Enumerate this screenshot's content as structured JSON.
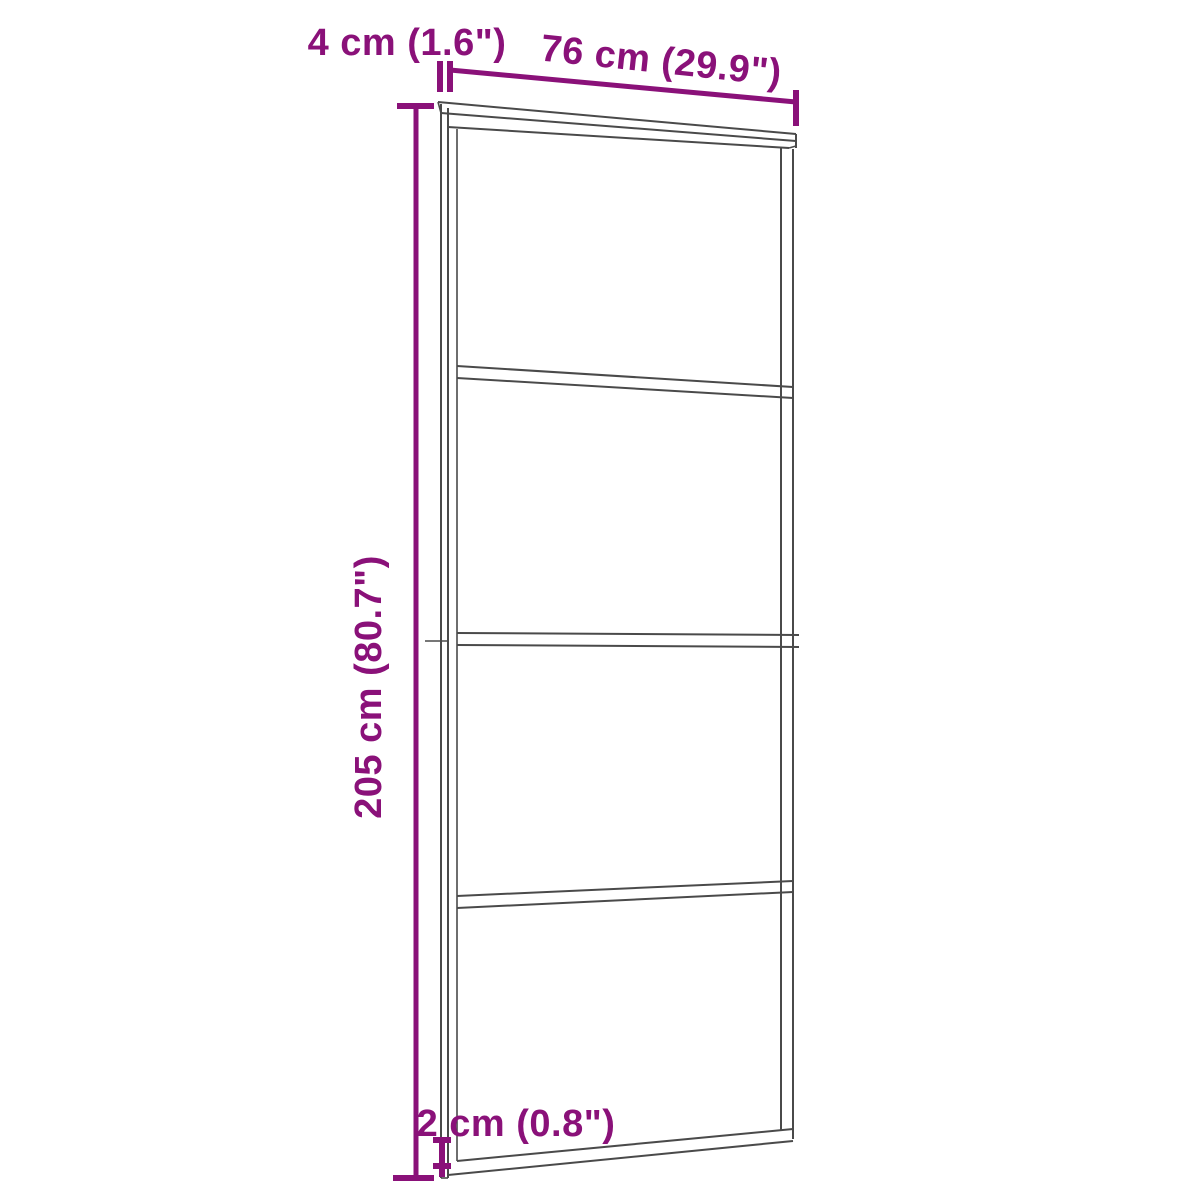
{
  "diagram": {
    "panel_count": 4,
    "colors": {
      "dimension": "#8A1179",
      "line": "#4A4A4A",
      "background": "#FFFFFF"
    },
    "labels": {
      "top_offset": "4 cm (1.6\")",
      "width": "76 cm (29.9\")",
      "height": "205 cm (80.7\")",
      "bottom_offset": "2 cm (0.8\")"
    }
  }
}
